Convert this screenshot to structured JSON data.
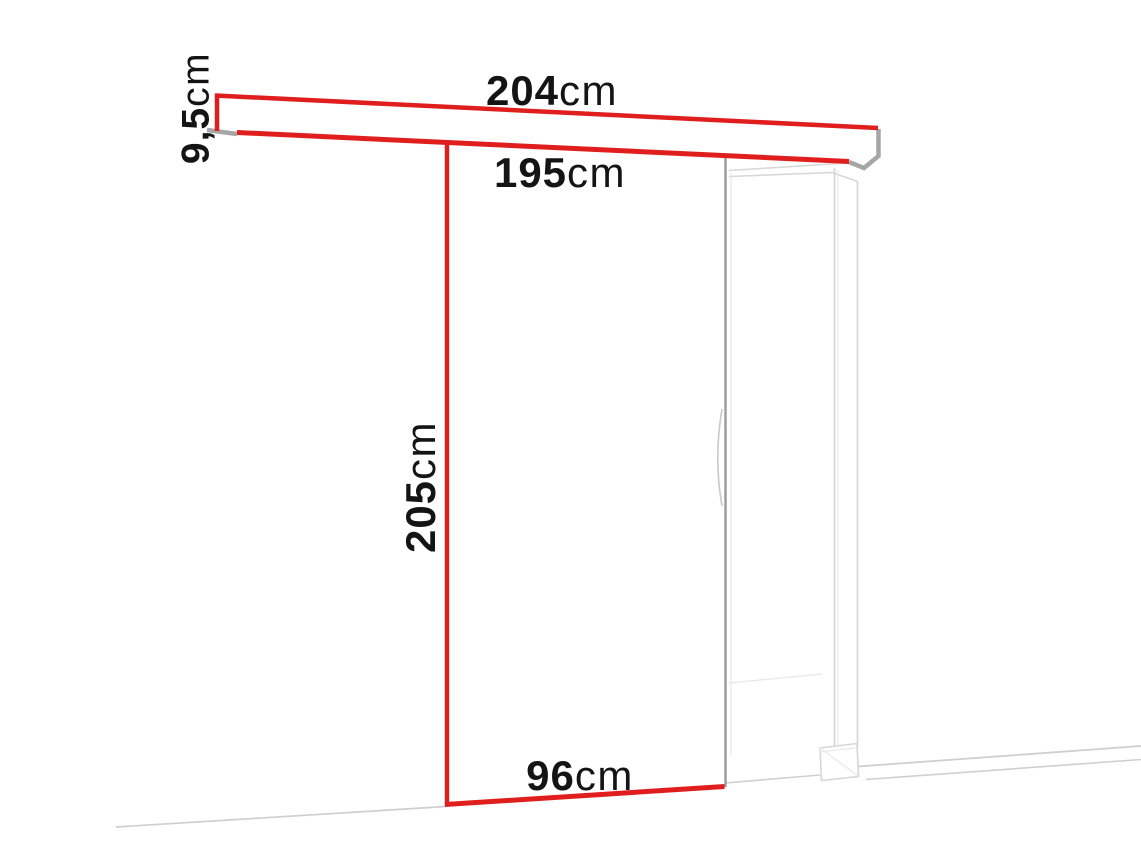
{
  "diagram": {
    "dimensions": {
      "track_width": {
        "value": "204",
        "unit": "cm"
      },
      "passage_width": {
        "value": "195",
        "unit": "cm"
      },
      "track_height": {
        "value": "9,5",
        "unit": "cm"
      },
      "door_height": {
        "value": "205",
        "unit": "cm"
      },
      "door_width": {
        "value": "96",
        "unit": "cm"
      }
    },
    "colors": {
      "red": "#e01e1e",
      "gray_cap": "#a6a6a6",
      "door_edge": "#9a9a9a",
      "frame": "#d7d7d7",
      "frame_faint": "#e9e9e9",
      "floor": "#cfcfcf",
      "text": "#141414"
    }
  }
}
